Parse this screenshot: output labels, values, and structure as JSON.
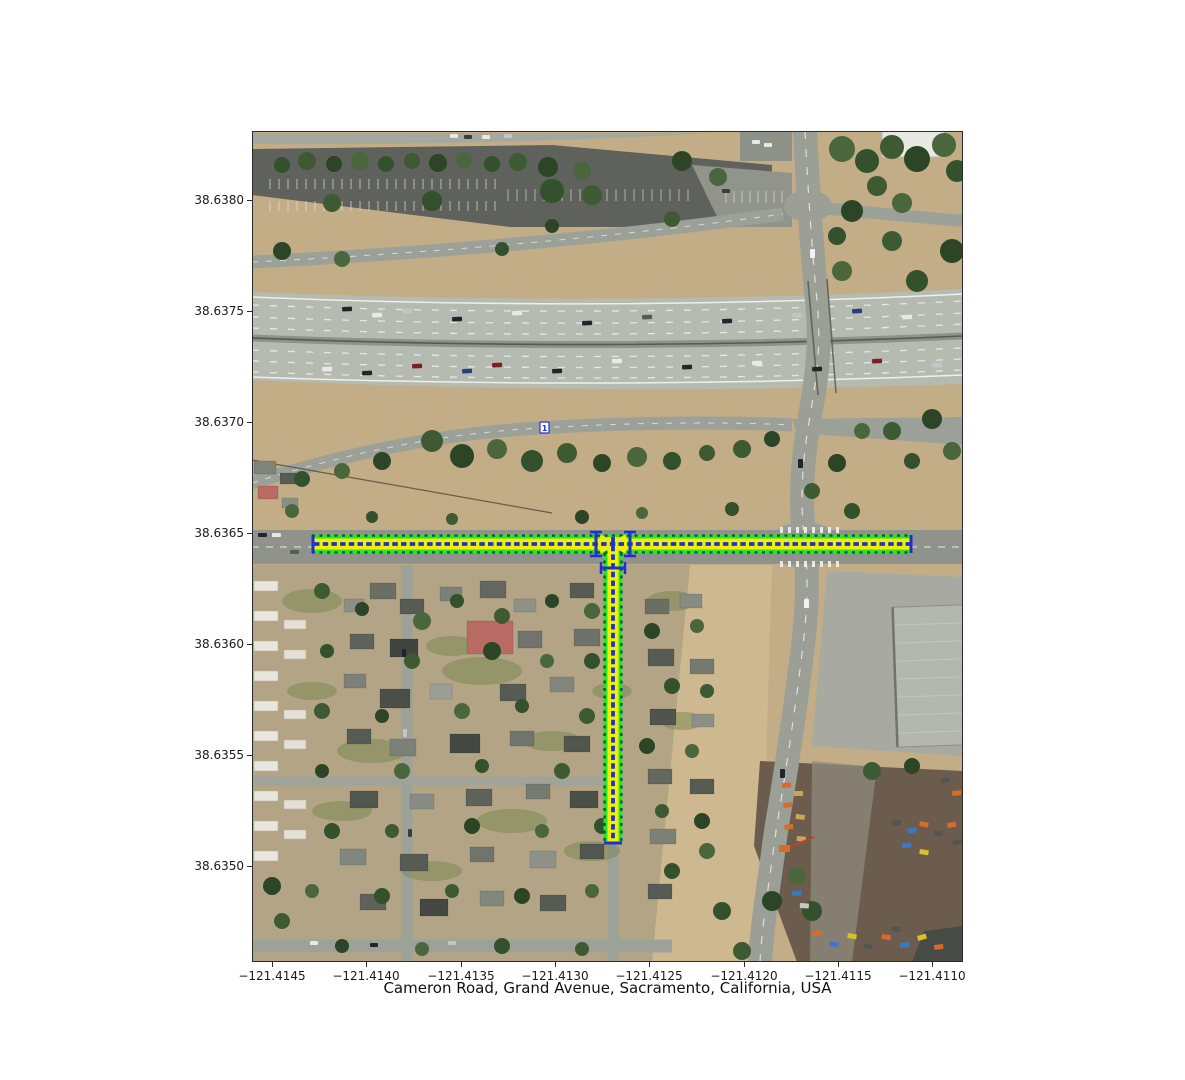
{
  "figure": {
    "title": "Cameron Road, Grand Avenue, Sacramento, California, USA",
    "background": "#ffffff"
  },
  "axes": {
    "x_ticks": [
      {
        "label": "−121.4145",
        "x": 272
      },
      {
        "label": "−121.4140",
        "x": 366
      },
      {
        "label": "−121.4135",
        "x": 461
      },
      {
        "label": "−121.4130",
        "x": 555
      },
      {
        "label": "−121.4125",
        "x": 649
      },
      {
        "label": "−121.4120",
        "x": 744
      },
      {
        "label": "−121.4115",
        "x": 838
      },
      {
        "label": "−121.4110",
        "x": 932
      }
    ],
    "y_ticks": [
      {
        "label": "38.6380",
        "y": 200
      },
      {
        "label": "38.6375",
        "y": 311
      },
      {
        "label": "38.6370",
        "y": 422
      },
      {
        "label": "38.6365",
        "y": 533
      },
      {
        "label": "38.6360",
        "y": 644
      },
      {
        "label": "38.6355",
        "y": 755
      },
      {
        "label": "38.6350",
        "y": 866
      }
    ]
  },
  "map": {
    "type": "satellite-with-route-overlay",
    "route_roads": [
      "Grand Avenue",
      "Cameron Road"
    ],
    "transit_marker_label": "1",
    "colors": {
      "route_edge_green": "#2ce32c",
      "route_lane_yellow": "#f0f005",
      "route_marking_blue": "#2030cf",
      "route_edge_dark": "#0a5a40"
    }
  }
}
